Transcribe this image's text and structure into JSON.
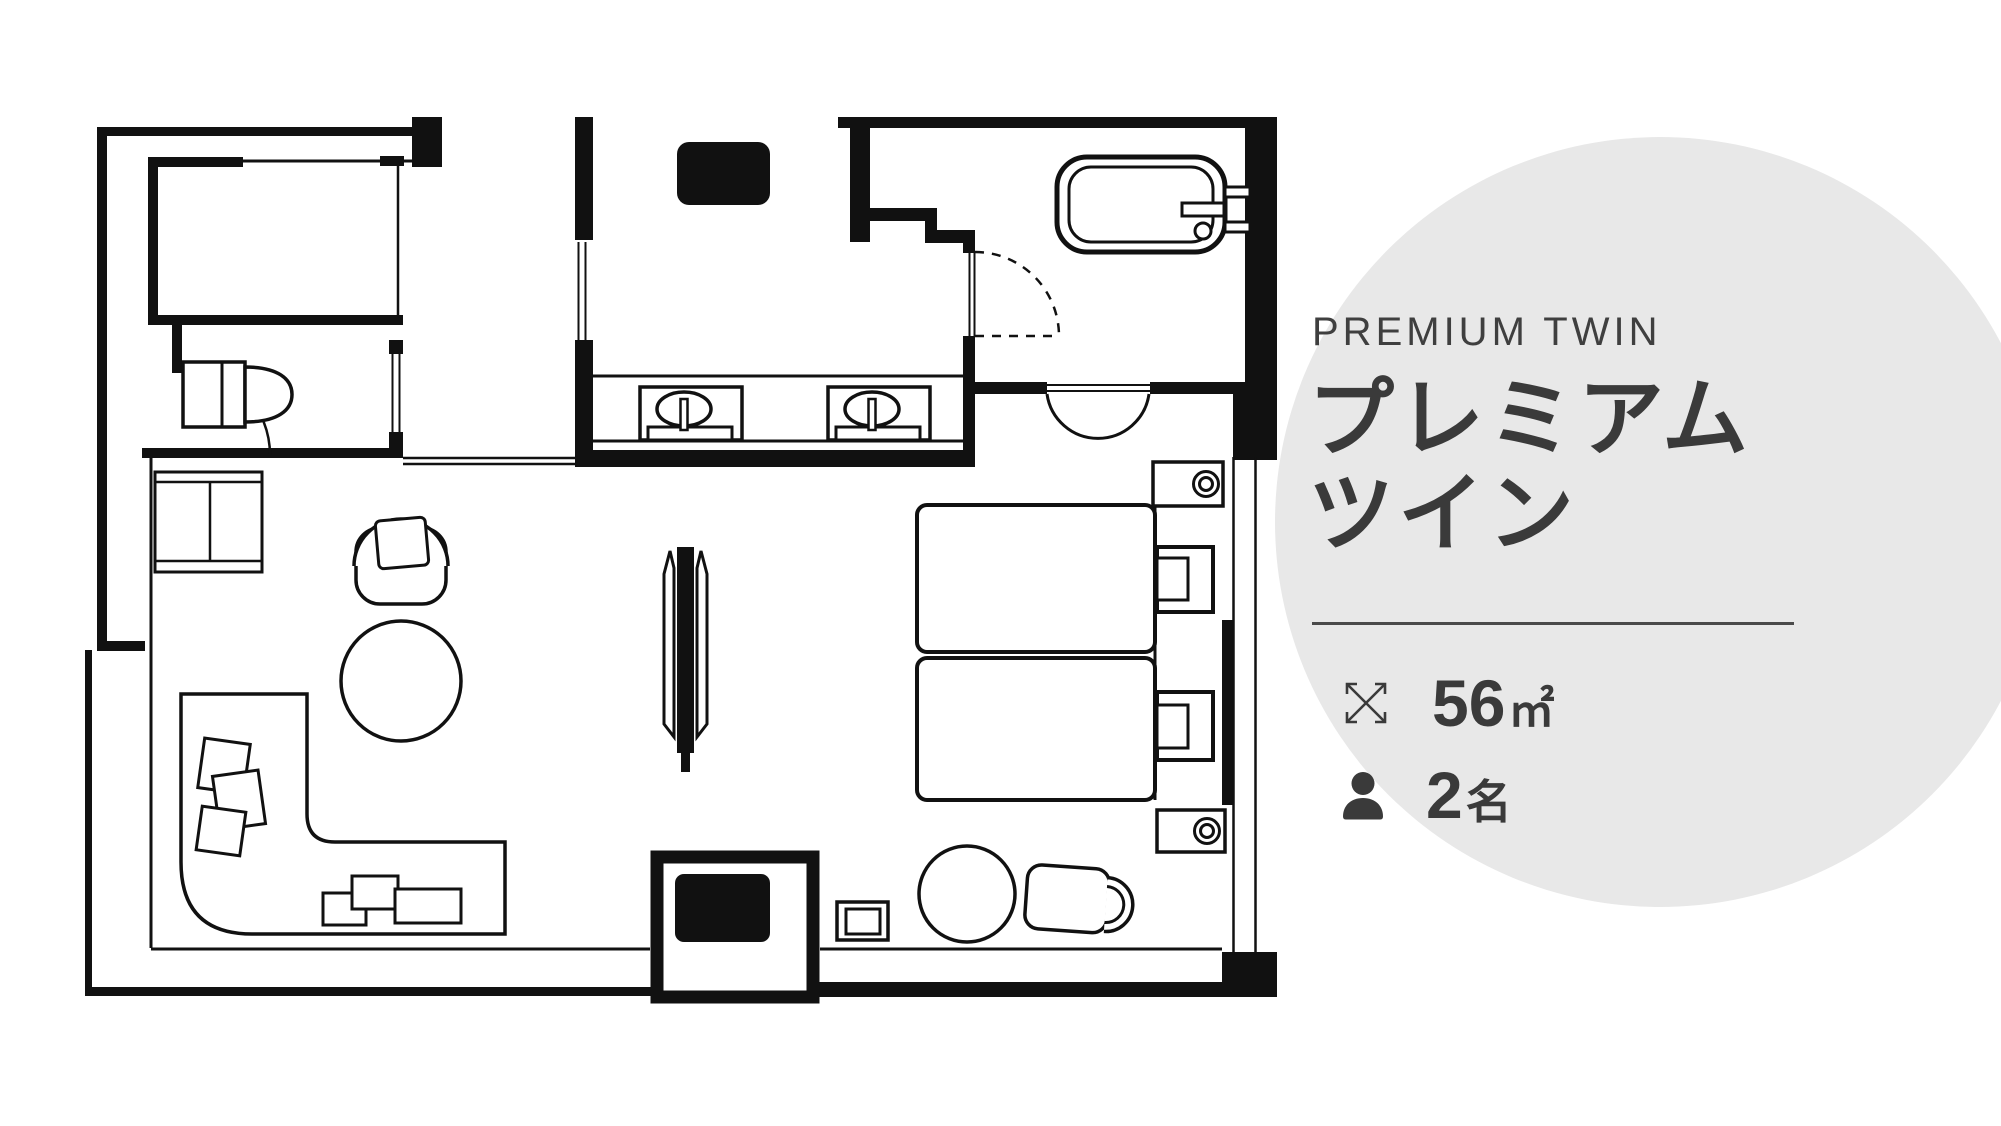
{
  "colors": {
    "canvas_bg": "#ffffff",
    "plan_line": "#111111",
    "wall_fill": "#111111",
    "circle_bg": "#e8e8e8",
    "text": "#3a3a3a"
  },
  "info_panel": {
    "category_label": "PREMIUM TWIN",
    "title_line1": "プレミアム",
    "title_line2": "ツイン",
    "stats": [
      {
        "icon": "expand-arrows-icon",
        "value": "56",
        "unit": "㎡"
      },
      {
        "icon": "person-icon",
        "value": "2",
        "unit": "名"
      }
    ]
  }
}
